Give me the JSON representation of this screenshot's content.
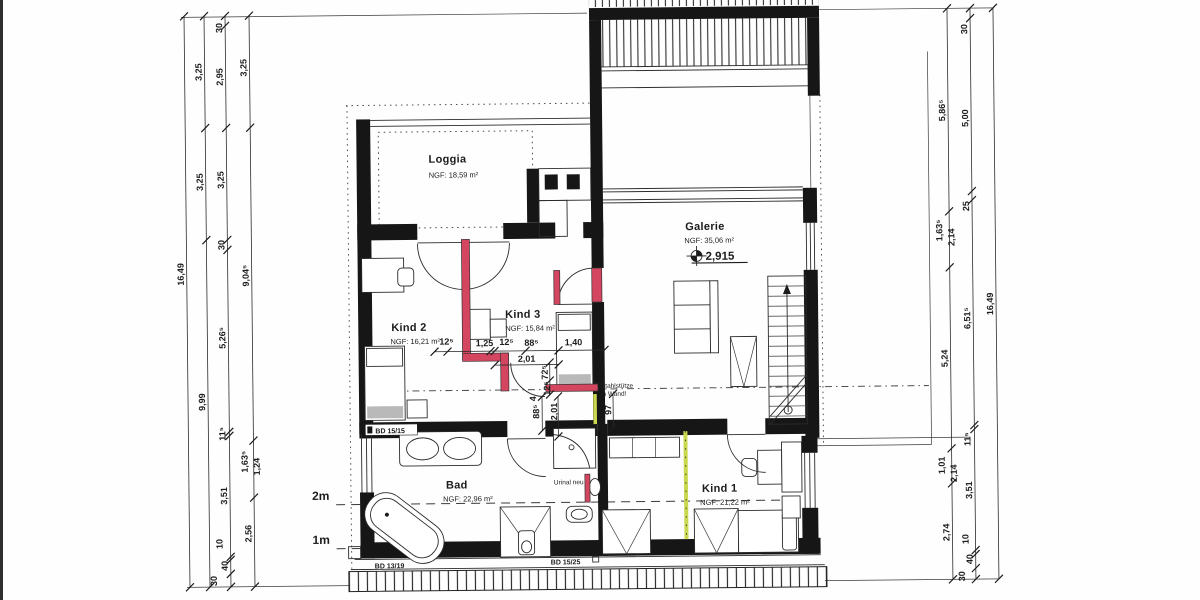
{
  "rooms": {
    "loggia": {
      "name": "Loggia",
      "area": "NGF: 18,59 m²"
    },
    "galerie": {
      "name": "Galerie",
      "area": "NGF: 35,06 m²",
      "level": "2,915"
    },
    "kind2": {
      "name": "Kind 2",
      "area": "NGF: 16,21 m²"
    },
    "kind3": {
      "name": "Kind 3",
      "area": "NGF: 15,84 m²"
    },
    "bad": {
      "name": "Bad",
      "area": "NGF: 22,96 m²"
    },
    "kind1": {
      "name": "Kind 1",
      "area": "NGF: 21,22 m²"
    }
  },
  "annotations": {
    "urinal": "Urinal neu",
    "stahl_line1": "Stahlstütze",
    "stahl_line2": "in Wand!",
    "bd_top": "BD 15/15",
    "bd_bottom_left": "BD 13/19",
    "bd_bottom_right": "BD 15/25",
    "line_2m": "2m",
    "line_1m": "1m"
  },
  "dims": {
    "left_total": [
      "16,49"
    ],
    "left_main": [
      "3,25",
      "3,25",
      "9,99"
    ],
    "left_detail": [
      "30",
      "2,95",
      "3,25",
      "30",
      "5,26⁵",
      "11⁵",
      "3,51",
      "10",
      "40",
      "30"
    ],
    "left_inner": [
      "3,25",
      "9,04⁵",
      "1,63⁵",
      "1,24",
      "2,56"
    ],
    "right_inner": [
      "5,86⁵",
      "1,63⁵",
      "2,14",
      "5,24",
      "1,01",
      "2,14",
      "2,74"
    ],
    "right_main": [
      "30",
      "5,00",
      "25",
      "6,51⁵",
      "11⁵",
      "3,51",
      "10",
      "40",
      "30"
    ],
    "right_total": [
      "16,49"
    ],
    "interior_h": [
      "12⁵",
      "1,25",
      "12⁵",
      "88⁵",
      "1,40",
      "2,01"
    ],
    "interior_v": [
      "72⁵",
      "12⁵",
      "4",
      "88⁵",
      "2,01",
      "97"
    ]
  },
  "colors": {
    "new_wall": "#d4455f",
    "demolition": "#c9d84e",
    "wall": "#161616"
  }
}
